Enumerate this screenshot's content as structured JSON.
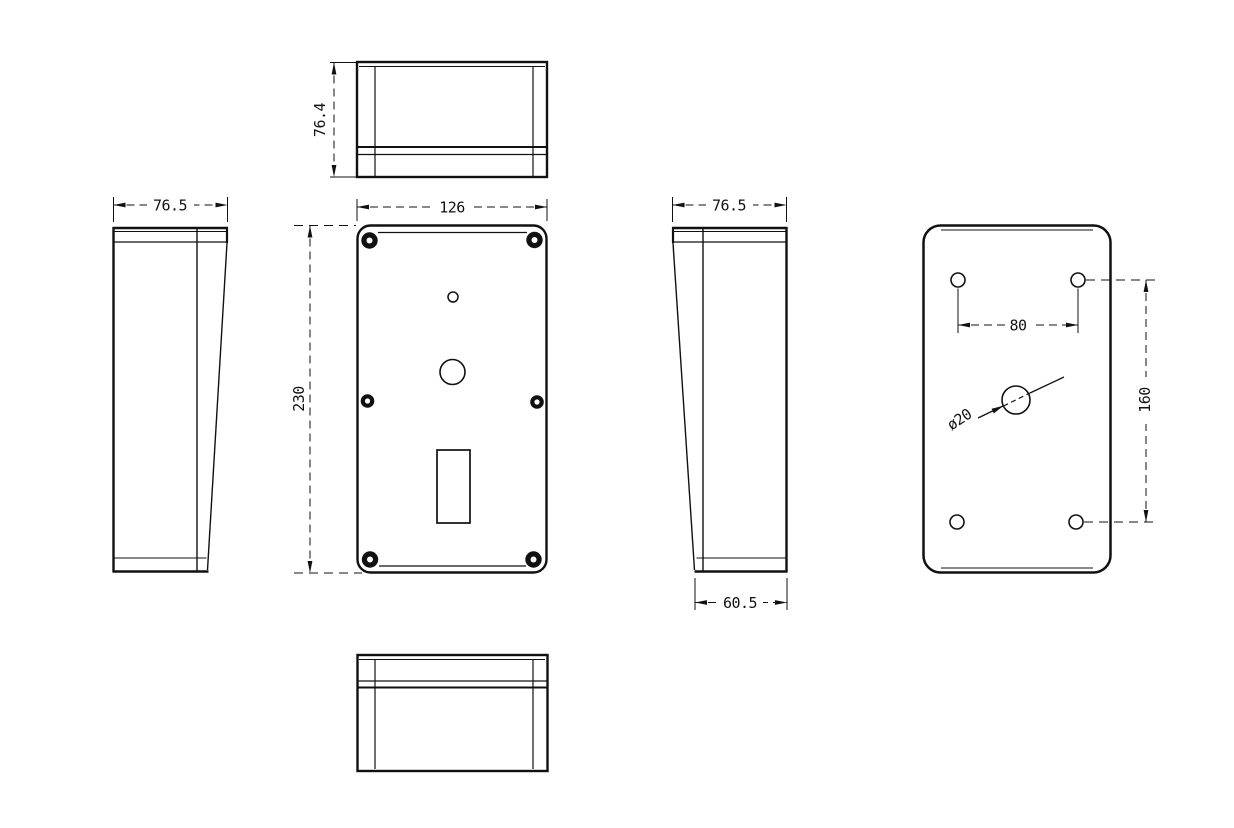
{
  "colors": {
    "background": "#ffffff",
    "line": "#111111"
  },
  "dims": {
    "top_depth": "76.4",
    "left_width": "76.5",
    "front_width": "126",
    "front_height": "230",
    "right_width": "76.5",
    "right_bottom_width": "60.5",
    "back_hole_spacing_h": "80",
    "back_hole_spacing_v": "160",
    "back_center_hole": "ø20"
  }
}
